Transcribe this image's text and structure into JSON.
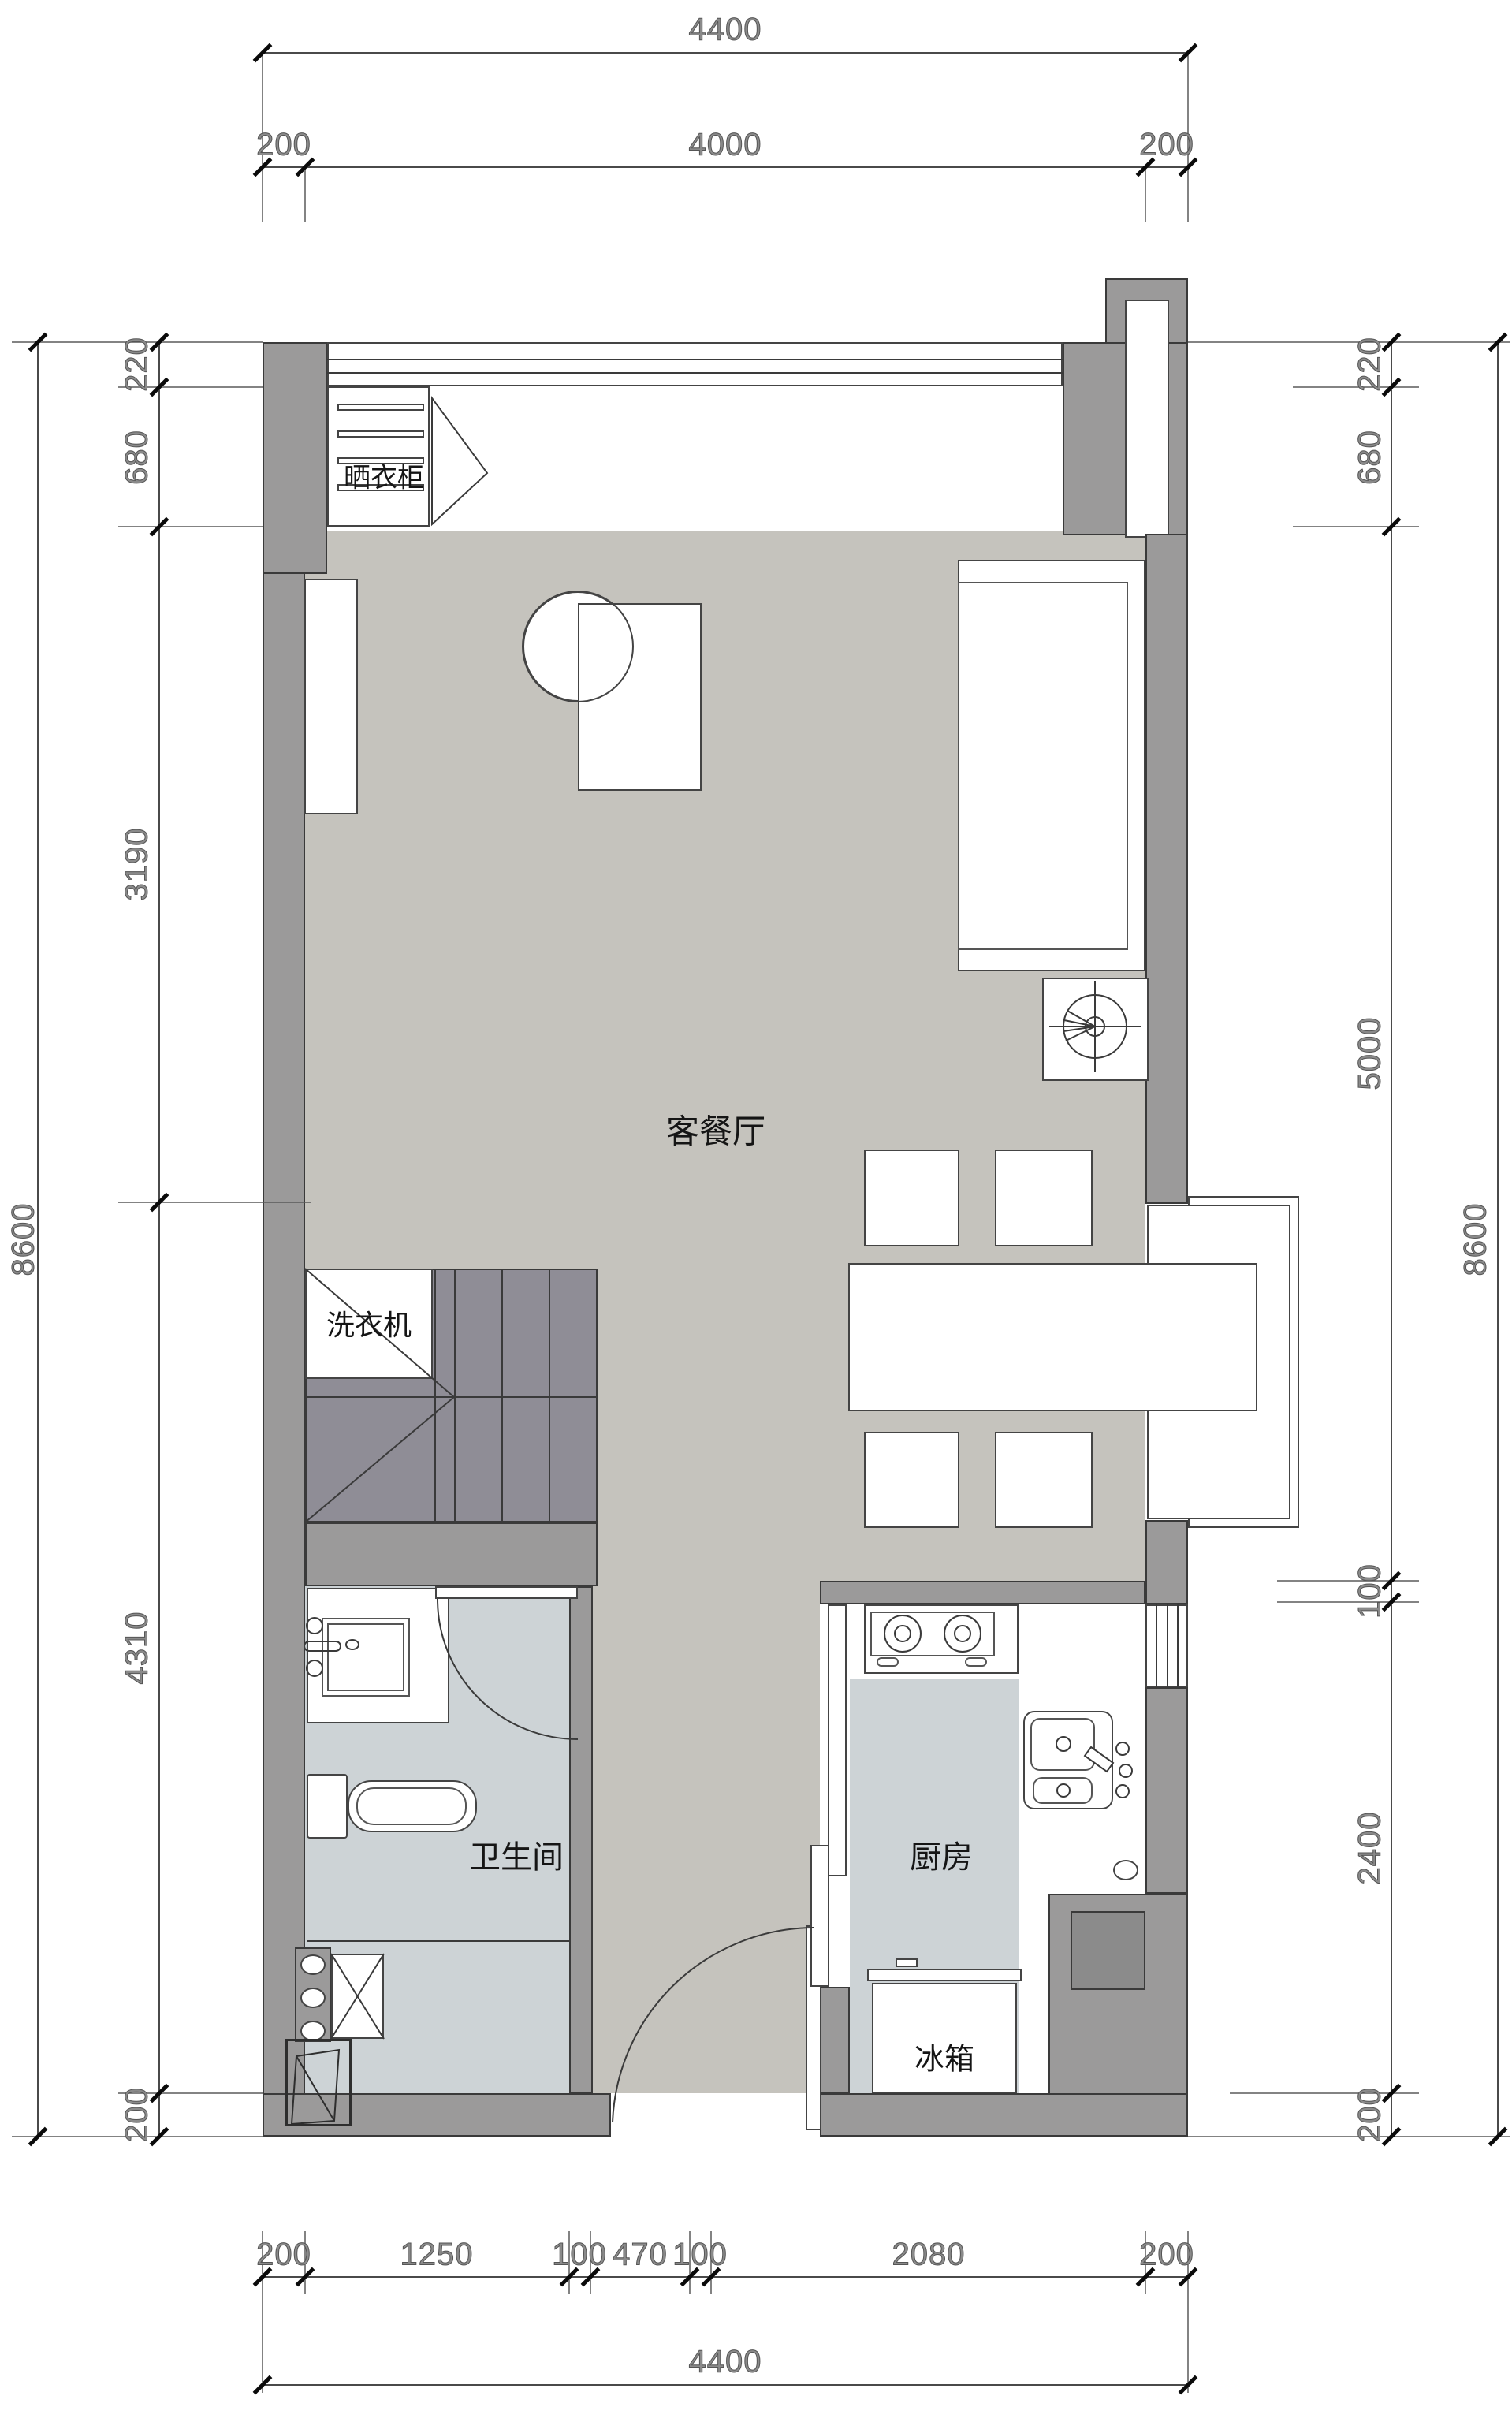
{
  "rooms": {
    "living": {
      "label": "客餐厅"
    },
    "bathroom": {
      "label": "卫生间"
    },
    "kitchen": {
      "label": "厨房"
    },
    "fridge": {
      "label": "冰箱"
    },
    "washer": {
      "label": "洗衣机"
    },
    "closet": {
      "label": "晒衣柜"
    }
  },
  "dims": {
    "top": {
      "total": "4400",
      "row2": [
        "200",
        "4000",
        "200"
      ]
    },
    "bottom": {
      "row1": [
        "200",
        "1250",
        "100",
        "470",
        "100",
        "2080",
        "200"
      ],
      "total": "4400"
    },
    "left": {
      "outer": "8600",
      "inner": [
        "220",
        "680",
        "3190",
        "4310",
        "200"
      ]
    },
    "right": {
      "outer": "8600",
      "inner": [
        "220",
        "680",
        "5000",
        "100",
        "2400",
        "200"
      ]
    }
  },
  "colors": {
    "wall": "#9b9a9a",
    "stair": "#8f8d96",
    "floor": "#c5c3bd",
    "wet": "#cdd3d6",
    "blockInner": "#8b8b8b",
    "line": "#3a3a3a",
    "dimline": "#4a4a4a",
    "dimtext": "#8a8a8a"
  }
}
